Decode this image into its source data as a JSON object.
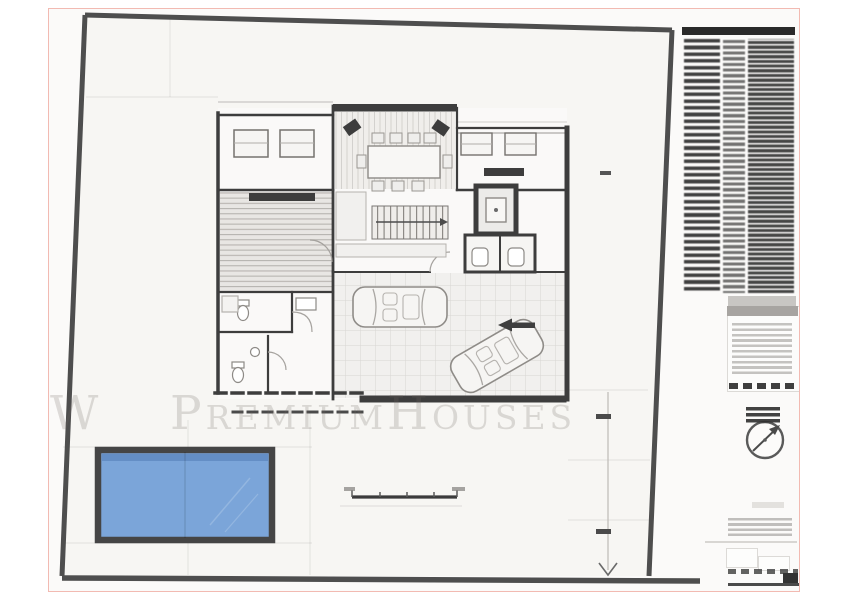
{
  "meta": {
    "kind": "architectural-floor-plan-sheet",
    "sheet": "ground floor plan with pool and site boundary"
  },
  "watermark": {
    "prefix": "W",
    "text": "PremiumHouses"
  },
  "colors": {
    "page_bg": "#ffffff",
    "sheet_bg": "#fbfaf9",
    "sheet_border": "#f2bab2",
    "site_fill": "#f7f6f3",
    "boundary": "#4e4e4e",
    "wall": "#3d3d3d",
    "wall_medium": "#5a5856",
    "line_faint": "#d9d7d4",
    "pool_fill": "#7ba5d9",
    "pool_dark": "#5c87bd",
    "pool_border": "#454545",
    "watermark": "rgba(112,107,99,0.22)",
    "panel_gray": "#a7a4a1",
    "legend_ink": "#2a2a2a"
  },
  "legend_table": {
    "header_bar": true,
    "columns": 3,
    "approx_rows": 38,
    "text_legible": false
  },
  "compass": {
    "needle_direction": "NE"
  },
  "scale_bar": {
    "tick_count": 5
  },
  "site": {
    "pool": true,
    "cars_in_garage": 2,
    "driveway_arrow": "down"
  }
}
